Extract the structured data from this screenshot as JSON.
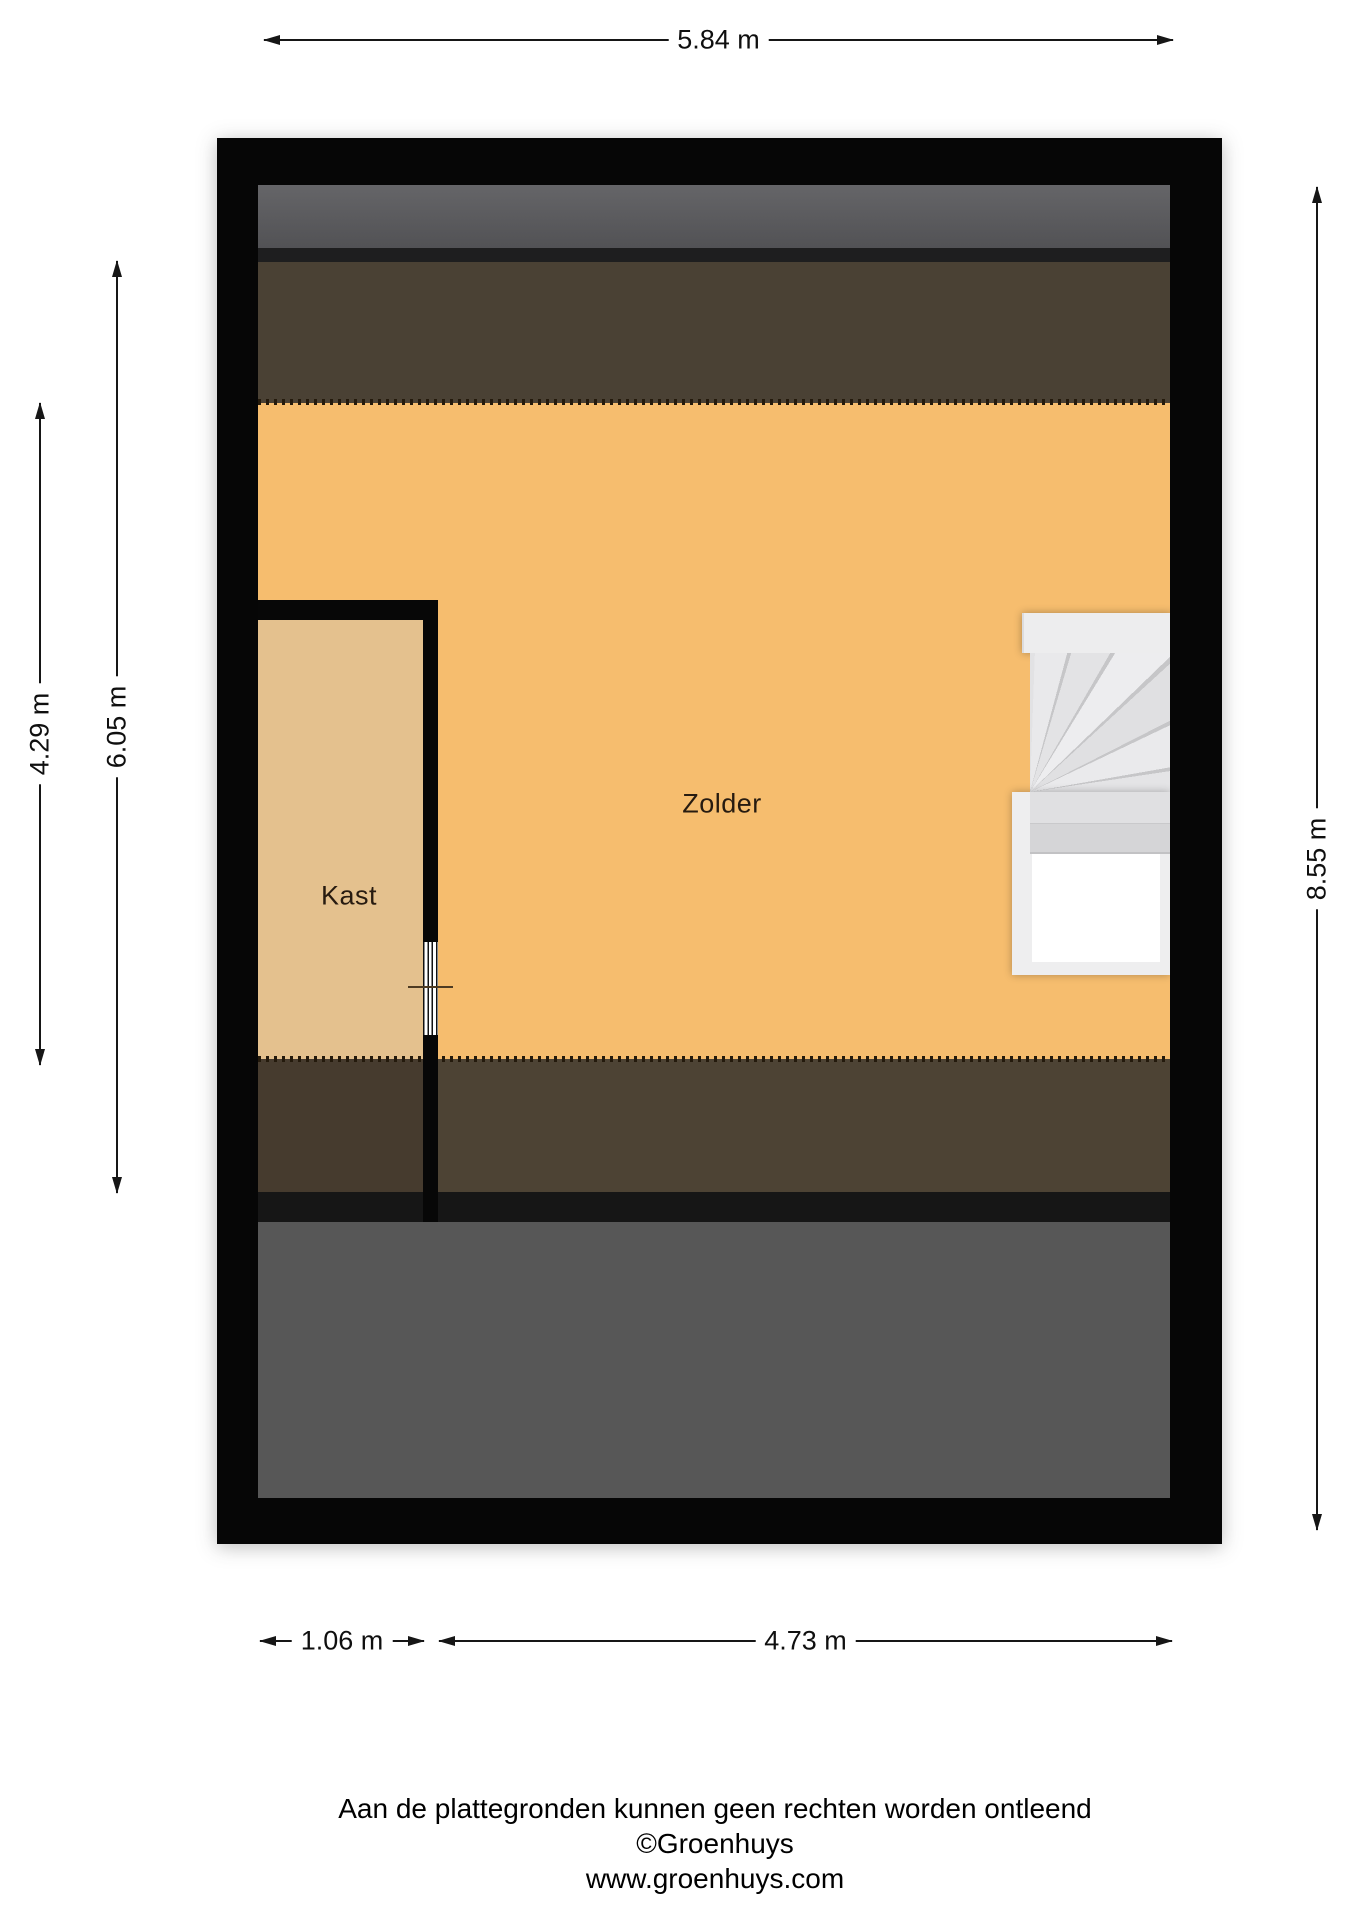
{
  "plan_title": "Zolder floor plan",
  "rooms": {
    "zolder": "Zolder",
    "kast": "Kast"
  },
  "dimensions": {
    "top": "5.84 m",
    "left_outer": "4.29 m",
    "left_inner": "6.05 m",
    "right": "8.55 m",
    "bottom_left": "1.06 m",
    "bottom_right": "4.73 m"
  },
  "footer": {
    "disclaimer": "Aan de plattegronden kunnen geen rechten worden ontleend",
    "copyright": "©Groenhuys",
    "website": "www.groenhuys.com"
  },
  "colors": {
    "zolder_floor": "#f6bd6e",
    "kast_floor": "#e4c18e",
    "sloped_roof_brown": "#4a4134",
    "roof_band_gray": "#58585a",
    "lower_floor_gray": "#575757",
    "wall_black": "#060606",
    "stairs_light_gray": "#ededee",
    "dimension_line": "#161616"
  }
}
